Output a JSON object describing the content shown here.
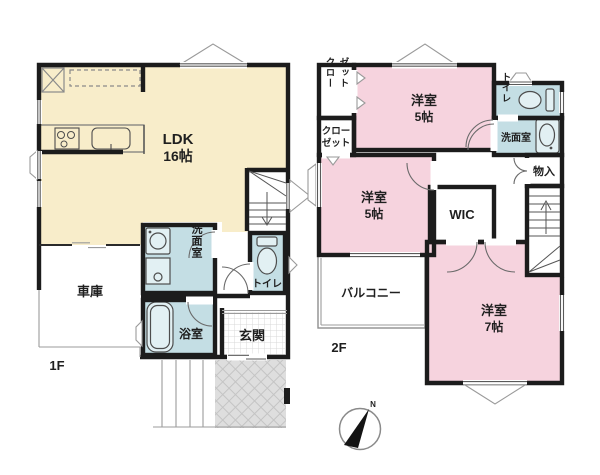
{
  "colors": {
    "cream": "#f8edca",
    "pink": "#f6d3de",
    "blue": "#c4dee4",
    "wall": "#1c1c1c",
    "porch": "#dedede"
  },
  "floor1": {
    "label": "1F",
    "ldk_name": "LDK",
    "ldk_size": "16帖",
    "garage": "車庫",
    "washroom": "洗面室",
    "bathroom": "浴室",
    "toilet": "トイレ",
    "entrance": "玄関"
  },
  "floor2": {
    "label": "2F",
    "bedroom_top_name": "洋室",
    "bedroom_top_size": "5帖",
    "bedroom_mid_name": "洋室",
    "bedroom_mid_size": "5帖",
    "bedroom_main_name": "洋室",
    "bedroom_main_size": "7帖",
    "closet_top_col1": "クロー",
    "closet_top_col2": "ゼット",
    "closet_lower_line1": "クロー",
    "closet_lower_line2": "ゼット",
    "wic": "WIC",
    "toilet": "トイレ",
    "washroom": "洗面室",
    "storage": "物入",
    "balcony": "バルコニー"
  },
  "compass": {
    "north": "N"
  }
}
